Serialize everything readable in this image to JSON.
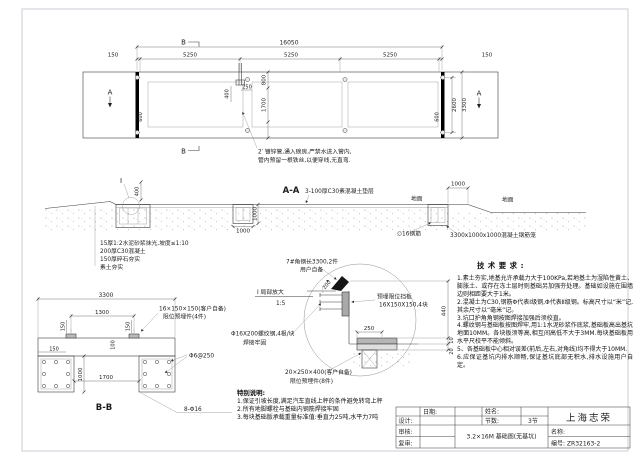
{
  "plan": {
    "dim_total": "16050",
    "dim_end_left": "150",
    "segments": [
      "5250",
      "5250",
      "5250"
    ],
    "dim_end_right": "150",
    "dim_width_inner": "2600",
    "dim_width_total": "3300",
    "dim_band": "800",
    "dim_inner_height": "1700",
    "dim_conduit_offset": "400",
    "dim_conduit": "250",
    "dim_bolt_left": "600",
    "dim_bolt_right": "600",
    "marker_a": "A",
    "marker_b": "B",
    "note_line1": "2′ 镀锌管,通入磅房,严禁水进入管内,",
    "note_line2": "管内预留一根铁丝,以便穿线,无直弯."
  },
  "aa": {
    "title": "A-A",
    "bedding": "3-100厚C30素混凝土垫层",
    "ground_left": "地面",
    "ground_right": "地面",
    "dim_1000_top": "1000",
    "dim_1000_depth": "1000",
    "dim_1000_width": "1000",
    "rebar": "∅16钢筋",
    "cage": "3300x1000x1000混凝土钢筋笼",
    "detail_mark": "I",
    "dim_400": "400",
    "layers": [
      "15厚1:2水泥砂浆抹光,坡度≤1:10",
      "200厚C30混凝土",
      "150厚碎石夯实",
      "素土夯实"
    ]
  },
  "bb": {
    "title": "B-B",
    "dim_3300": "3300",
    "dim_1300": "1300",
    "dim_150_left": "150",
    "dim_150_right": "150",
    "dim_150_edge": "150",
    "dim_100": "100",
    "dim_1000": "1000",
    "dim_1700": "1700",
    "plate_line1": "16×150×150(客户自备)",
    "plate_line2": "限位预埋件(4件)",
    "stirrup": "Φ6@250",
    "main_rebar": "8-Φ16"
  },
  "detail": {
    "angle_line1": "7#角钢长3300,2件",
    "angle_line2": "用户自备",
    "title_line1": "Ⅰ 局部放大",
    "title_line2": "1:5",
    "plate_line1": "预埋限位挡板",
    "plate_line2": "16X150X150,4块",
    "rod_line1": "Φ16X200螺纹钢,4根/块",
    "rod_line2": "焊接牢固",
    "embed_line1": "20×250×400(客户自备)",
    "embed_line2": "限位预埋件(8件)",
    "dim_200": "200",
    "dim_250": "250",
    "dim_440": "440",
    "dim_10": "10",
    "dim_20": "20"
  },
  "tech": {
    "title": "技术要求:",
    "items": [
      "1.素土夯实,地基允许承载力大于100KPa,若地基土为湿陷性黄土、膨胀土、或存在冻土层时则基础另加强夯处理。基础如设施在围墙边则相距要大于1米。",
      "2.混凝土为C30,钢筋Φ代表Ⅰ级钢,Φ代表Ⅱ级钢。标高尺寸以“米”记,其余尺寸以“毫米”记。",
      "3.坑口护角角钢按图焊接加强后须校直。",
      "4.螺纹钢与基础板按图焊牢,用1:1水泥砂浆作底浆,基础板高出基坑地面10MM。各块板须等高,相互间高低不大于3MM.每块基础板用水平尺校平不能倾斜。",
      "5、各基础板中心相对误差(前后,左右,对角线)均不得大于10MM.",
      "6.应保证基坑内排水顺畅,保证基坑底部无积水,排水设施用户自定。"
    ]
  },
  "special": {
    "title": "特别说明:",
    "items": [
      "1.保证引坡长度,满足汽车直线上秤的条件避免转弯上秤",
      "2.所有地脚螺栓与基础内钢筋焊接牢固",
      "3.每块基础版承载重量标准值:垂直力25吨,水平力7吨"
    ]
  },
  "titleblock": {
    "date_label": "日期:",
    "name_label": "姓名:",
    "sections_label": "节数:",
    "sections_value": "3节",
    "design_label": "设计:",
    "check_label": "审核:",
    "recheck_label": "复审:",
    "drawing_title": "3.2×16M 基础图(无基坑)",
    "company": "上海志荣",
    "title_label": "名称:",
    "number": "编号: ZR32163-2"
  }
}
